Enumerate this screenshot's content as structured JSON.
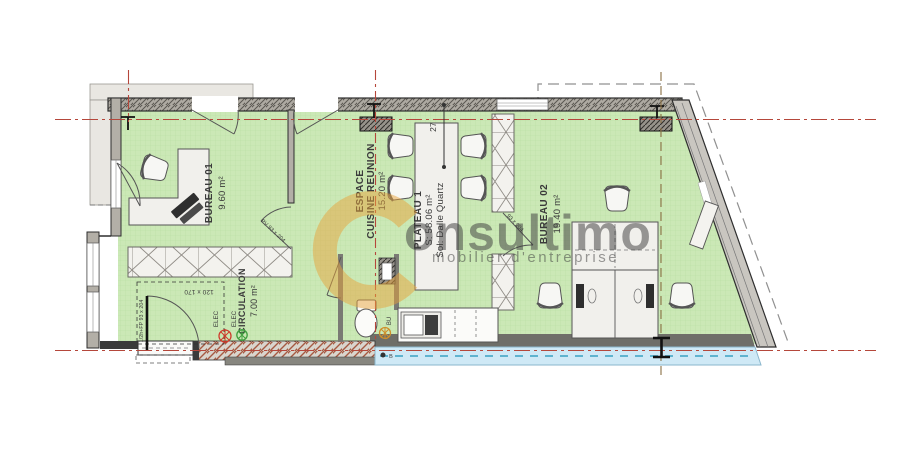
{
  "drawing_type": "architectural floor plan",
  "watermark": {
    "logo_letter": "C",
    "word": "onsultimo",
    "tagline": "mobilier d'entreprise"
  },
  "rooms": {
    "bureau01": {
      "name": "BUREAU 01",
      "area": "9.60 m²"
    },
    "espace": {
      "line1": "ESPACE",
      "line2": "CUISINE REUNION",
      "area": "15.20 m²"
    },
    "plateau": {
      "name": "PLATEAU 1",
      "area": "S: 58.06 m²",
      "floor": "Sol: Dalle Quartz"
    },
    "bureau02": {
      "name": "BUREAU 02",
      "area": "19.40 m²"
    },
    "circulation": {
      "name": "CIRCULATION",
      "area": "7.00 m²"
    }
  },
  "annotations": {
    "dimension_27": "27",
    "door_frame": "120 x 170",
    "door_bureau01": "PV 93 x 204",
    "door_bureau02": "93 x 204",
    "entrance_door": "1/2h+FP 93 x 204",
    "elec": "ELEC",
    "bu": "BU",
    "facade_marker": "B"
  },
  "colors": {
    "floor_green": "#cbe8b6",
    "wall_gray": "#b3afa7",
    "centerline_red": "#b5473b",
    "construction_brown": "#8a7044",
    "facade_blue": "#cfe9f6",
    "brick_hatch": "#a65a42",
    "watermark_orange": "#e8a33c",
    "elec_red": "#cf3a2c",
    "elec_green": "#3f9f3f",
    "bu_orange": "#cf8f2a"
  }
}
